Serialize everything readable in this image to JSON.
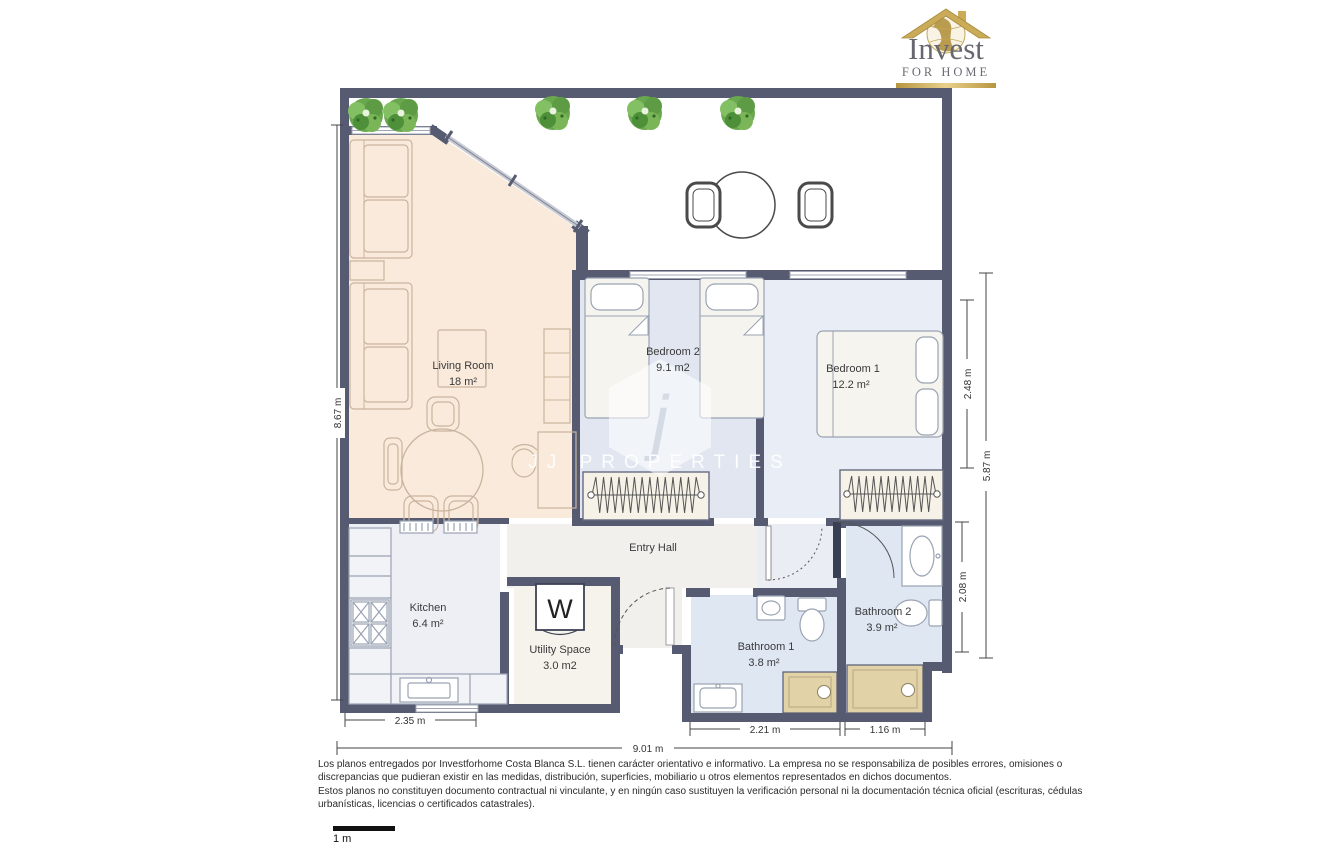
{
  "logo": {
    "title": "Invest",
    "subtitle": "FOR HOME"
  },
  "watermark": {
    "monogram": "j",
    "label": "JJ PROPERTIES"
  },
  "rooms": {
    "living": {
      "name": "Living Room",
      "area": "18 m²"
    },
    "bedroom2": {
      "name": "Bedroom 2",
      "area": "9.1 m2"
    },
    "bedroom1": {
      "name": "Bedroom 1",
      "area": "12.2 m²"
    },
    "kitchen": {
      "name": "Kitchen",
      "area": "6.4 m²"
    },
    "utility": {
      "name": "Utility Space",
      "area": "3.0 m2"
    },
    "entry": {
      "name": "Entry Hall"
    },
    "bathroom1": {
      "name": "Bathroom 1",
      "area": "3.8 m²"
    },
    "bathroom2": {
      "name": "Bathroom 2",
      "area": "3.9 m²"
    }
  },
  "fixtures": {
    "washer_label": "W"
  },
  "dimensions": {
    "left_height": "8.67 m",
    "right_upper": "2.48 m",
    "right_total": "5.87 m",
    "right_lower": "2.08 m",
    "bottom_kitchen": "2.35 m",
    "bottom_bath1": "2.21 m",
    "bottom_bath2": "1.16 m",
    "bottom_total": "9.01 m"
  },
  "scalebar": {
    "label": "1 m"
  },
  "disclaimer": {
    "lines": [
      "Los planos entregados por Investforhome Costa Blanca S.L. tienen carácter orientativo e informativo. La empresa no se responsabiliza de posibles errores, omisiones o",
      "discrepancias que pudieran existir en las medidas, distribución, superficies, mobiliario u otros elementos representados en dichos documentos.",
      "Estos planos no constituyen documento contractual ni vinculante, y en ningún caso sustituyen la verificación personal ni la documentación técnica oficial (escrituras, cédulas",
      "urbanísticas, licencias o certificados catastrales)."
    ]
  },
  "colors": {
    "wall": "#565b72",
    "living_floor": "#faeadb",
    "kitchen_floor": "#edeff5",
    "bedroom2_floor": "#e1e6f0",
    "bedroom1_floor": "#e9edf5",
    "bathroom_floor": "#dfe7f3",
    "entry_floor": "#f1f0ec",
    "utility_floor": "#f5f3ec",
    "corridor_floor": "#eaeef4",
    "wardrobe_fill": "#f6f2e7",
    "shower_tan": "#e2d2a8",
    "tree_green": "#69a84e",
    "logo_gold": "#c2a45c",
    "logo_text": "#6b6b74"
  }
}
